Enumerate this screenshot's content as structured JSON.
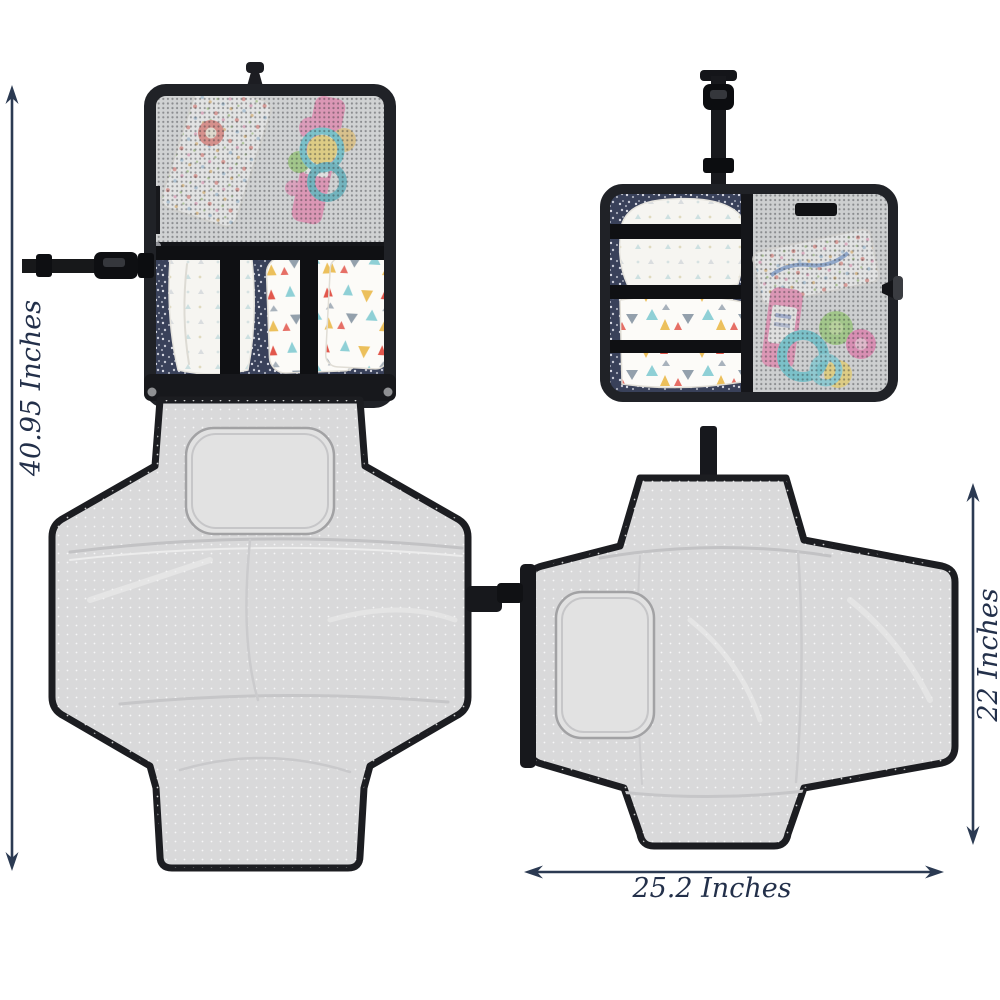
{
  "image": {
    "kind": "product-dimension-photo",
    "background": "#ffffff"
  },
  "annotations": {
    "style": {
      "color": "#23304a",
      "arrow_color": "#2b3a52",
      "font_style": "italic-serif"
    },
    "total_height": {
      "label": "40.95 Inches",
      "orientation": "vertical",
      "position": "left"
    },
    "mat_height": {
      "label": "22 Inches",
      "orientation": "vertical",
      "position": "right"
    },
    "mat_width": {
      "label": "25.2 Inches",
      "orientation": "horizontal",
      "position": "bottom"
    }
  },
  "views": [
    {
      "name": "changing-station-open-hanging",
      "caption": "fully unfolded hanging view with mesh pocket, diaper pockets and padded mat"
    },
    {
      "name": "clutch-folded-hanging-strap",
      "caption": "folded clutch with hanging buckle strap"
    },
    {
      "name": "changing-mat-open-flat",
      "caption": "changing mat opened flat with head pillow"
    }
  ],
  "palette": {
    "trim_black": "#1c1d22",
    "strap_black": "#101114",
    "mat_gray": "#d9d9da",
    "pillow_gray": "#e2e2e2",
    "navy_fabric": "#39415a",
    "mesh_gray": "#c7c9cb",
    "diaper_white": "#f6f5f1",
    "triangle_teal": "#8fd0d6",
    "triangle_mustard": "#ecc05c",
    "triangle_coral": "#e2574c",
    "triangle_slate": "#93a0ac",
    "toy_teal": "#2fb9c6",
    "toy_pink": "#e8559a",
    "toy_green": "#7cc24a",
    "toy_yellow": "#f2cf3e",
    "tube_pink": "#ee649e"
  }
}
